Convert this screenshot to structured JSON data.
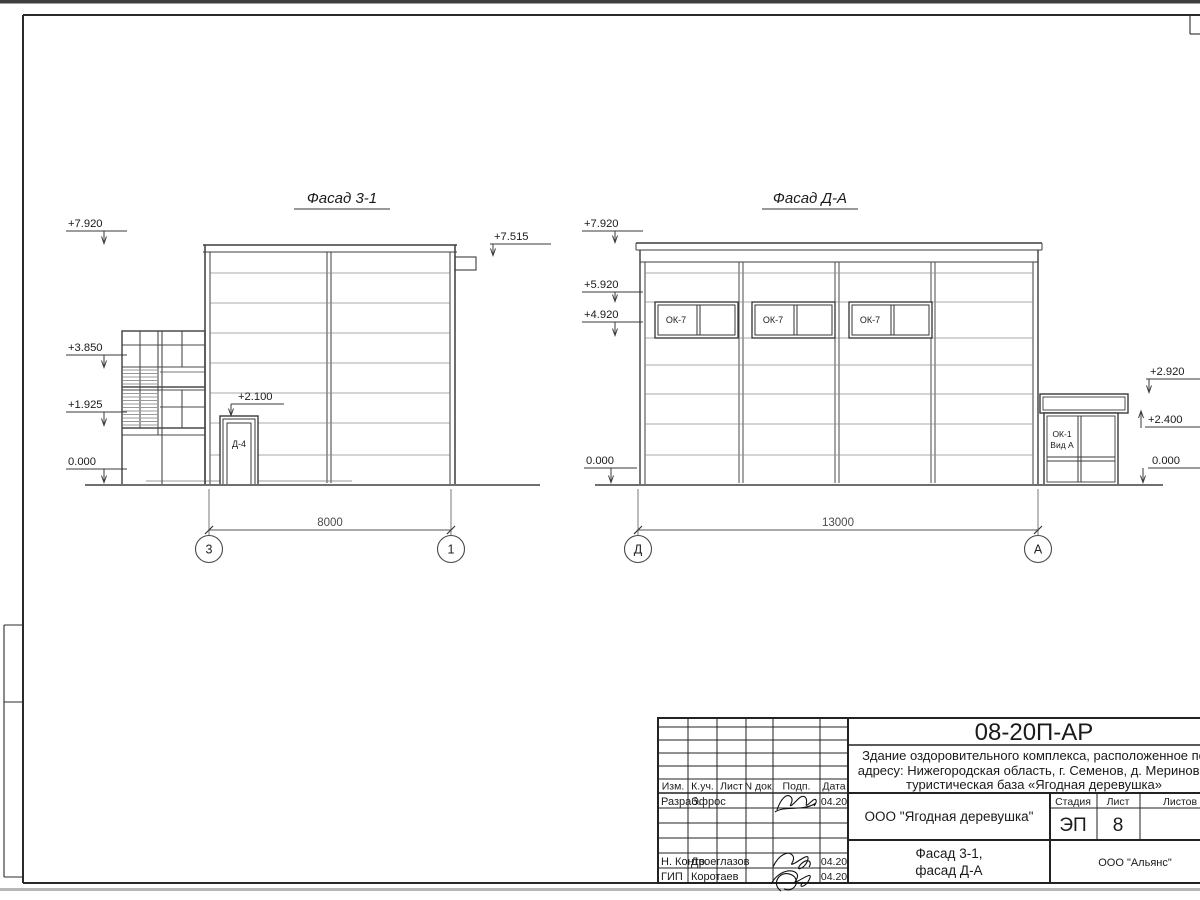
{
  "colors": {
    "paper": "#ffffff",
    "ink": "#1a1a1a",
    "thin_line": "#8d8d8d",
    "dim_line": "#555555"
  },
  "sheet": {
    "left_facade": {
      "title": "Фасад 3-1",
      "marks": {
        "m7920": "+7.920",
        "m7515": "+7.515",
        "m3850": "+3.850",
        "m1925": "+1.925",
        "m0": "0.000",
        "m2100": "+2.100"
      },
      "door_label": "Д-4",
      "dim": "8000",
      "axis_left": "3",
      "axis_right": "1"
    },
    "right_facade": {
      "title": "Фасад Д-А",
      "marks": {
        "m7920": "+7.920",
        "m5920": "+5.920",
        "m4920": "+4.920",
        "m0l": "0.000",
        "m2920": "+2.920",
        "m2400": "+2.400",
        "m0r": "0.000"
      },
      "window_label": "ОК-7",
      "annex_label_1": "ОК-1",
      "annex_label_2": "Вид А",
      "dim": "13000",
      "axis_left": "Д",
      "axis_right": "А"
    },
    "title_block": {
      "doc_number": "08-20П-АР",
      "description_line1": "Здание оздоровительного комплекса, расположенное по",
      "description_line2": "адресу: Нижегородская область, г. Семенов, д. Мериново,",
      "description_line3": "туристическая база «Ягодная деревушка»",
      "columns": {
        "izm": "Изм.",
        "kuch": "К.уч.",
        "list": "Лист",
        "ndoc": "N док.",
        "podp": "Подп.",
        "data": "Дата"
      },
      "rows": {
        "razrab_label": "Разраб.",
        "razrab_name": "Эфрос",
        "razrab_date": "04.20",
        "nkontr_label": "Н. Контр.",
        "nkontr_name": "Двоеглазов",
        "nkontr_date": "04.20",
        "gip_label": "ГИП",
        "gip_name": "Коротаев",
        "gip_date": "04.20"
      },
      "org": "ООО \"Ягодная деревушка\"",
      "stage_label": "Стадия",
      "sheet_label": "Лист",
      "sheets_label": "Листов",
      "stage": "ЭП",
      "sheet_number": "8",
      "subject_line1": "Фасад 3-1,",
      "subject_line2": "фасад Д-А",
      "company": "ООО \"Альянс\""
    }
  }
}
